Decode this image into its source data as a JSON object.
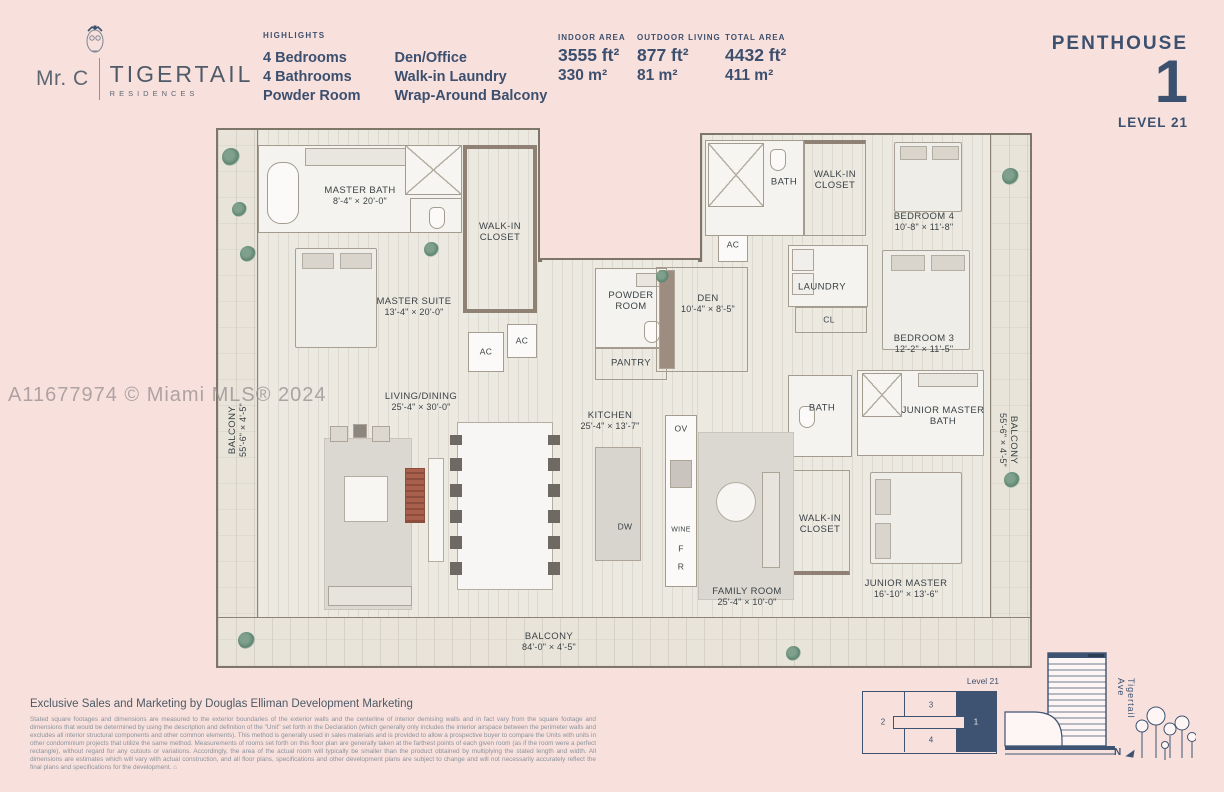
{
  "colors": {
    "background": "#f8e1dd",
    "navy": "#3c5170",
    "floor": "#ece9e1",
    "keyplan_fill": "#3e5371",
    "watermark_gray": "#968c8f"
  },
  "brand": {
    "mr_c": "Mr. C",
    "name": "TIGERTAIL",
    "sub": "RESIDENCES",
    "owl_icon": "owl-with-bow-tie"
  },
  "header": {
    "highlights_title": "HIGHLIGHTS",
    "highlights_col1": [
      "4 Bedrooms",
      "4 Bathrooms",
      "Powder Room"
    ],
    "highlights_col2": [
      "Den/Office",
      "Walk-in Laundry",
      "Wrap-Around Balcony"
    ],
    "stats": [
      {
        "label": "INDOOR AREA",
        "ft": "3555 ft²",
        "m": "330 m²"
      },
      {
        "label": "OUTDOOR LIVING",
        "ft": "877 ft²",
        "m": "81 m²"
      },
      {
        "label": "TOTAL AREA",
        "ft": "4432 ft²",
        "m": "411 m²"
      }
    ],
    "unit_type": "PENTHOUSE",
    "unit_number": "1",
    "level": "LEVEL 21"
  },
  "watermark": "A11677974 © Miami MLS® 2024",
  "plan": {
    "rooms": {
      "master_bath": {
        "name": "MASTER BATH",
        "dims": "8'-4\" × 20'-0\""
      },
      "master_wic": {
        "name": "WALK-IN CLOSET"
      },
      "master_suite": {
        "name": "MASTER SUITE",
        "dims": "13'-4\" × 20'-0\""
      },
      "living_dining": {
        "name": "LIVING/DINING",
        "dims": "25'-4\" × 30'-0\""
      },
      "kitchen": {
        "name": "KITCHEN",
        "dims": "25'-4\" × 13'-7\""
      },
      "powder_room": {
        "name": "POWDER ROOM"
      },
      "pantry": {
        "name": "PANTRY"
      },
      "den": {
        "name": "DEN",
        "dims": "10'-4\" × 8'-5\""
      },
      "bath_top": {
        "name": "BATH"
      },
      "wic_bed4": {
        "name": "WALK-IN CLOSET"
      },
      "bedroom4": {
        "name": "BEDROOM 4",
        "dims": "10'-8\" × 11'-8\""
      },
      "laundry": {
        "name": "LAUNDRY"
      },
      "cl": {
        "name": "CL"
      },
      "bedroom3": {
        "name": "BEDROOM 3",
        "dims": "12'-2\" × 11'-5\""
      },
      "jr_master_bath": {
        "name": "JUNIOR MASTER BATH"
      },
      "bath_jr": {
        "name": "BATH"
      },
      "wic_jr": {
        "name": "WALK-IN CLOSET"
      },
      "jr_master": {
        "name": "JUNIOR MASTER",
        "dims": "16'-10\" × 13'-6\""
      },
      "family_room": {
        "name": "FAMILY ROOM",
        "dims": "25'-4\" × 10'-0\""
      },
      "balcony_left": {
        "name": "BALCONY",
        "dims": "55'-6\" × 4'-5\""
      },
      "balcony_right": {
        "name": "BALCONY",
        "dims": "55'-6\" × 4'-5\""
      },
      "balcony_bottom": {
        "name": "BALCONY",
        "dims": "84'-0\" × 4'-5\""
      }
    },
    "labels": {
      "ac": "AC",
      "ov": "OV",
      "dw": "DW",
      "wine": "WINE",
      "f": "F",
      "r": "R"
    }
  },
  "footer": {
    "exclusive": "Exclusive Sales and Marketing by Douglas Elliman Development Marketing",
    "disclaimer": "Stated square footages and dimensions are measured to the exterior boundaries of the exterior walls and the centerline of interior demising walls and in fact vary from the square footage and dimensions that would be determined by using the description and definition of the \"Unit\" set forth in the Declaration (which generally only includes the interior airspace between the perimeter walls and excludes all interior structural components and other common elements). This method is generally used in sales materials and is provided to allow a prospective buyer to compare the Units with units in other condominium projects that utilize the same method. Measurements of rooms set forth on this floor plan are generally taken at the farthest points of each given room (as if the room were a perfect rectangle), without regard for any cutouts or variations. Accordingly, the area of the actual room will typically be smaller than the product obtained by multiplying the stated length and width. All dimensions are estimates which will vary with actual construction, and all floor plans, specifications and other development plans are subject to change and will not necessarily accurately reflect the final plans and specifications for the development.",
    "eho_icon": "⌂"
  },
  "keyplan": {
    "level_label": "Level 21",
    "units": [
      "2",
      "3",
      "4",
      "1"
    ],
    "street": "Tigertail Ave",
    "north": "N"
  }
}
